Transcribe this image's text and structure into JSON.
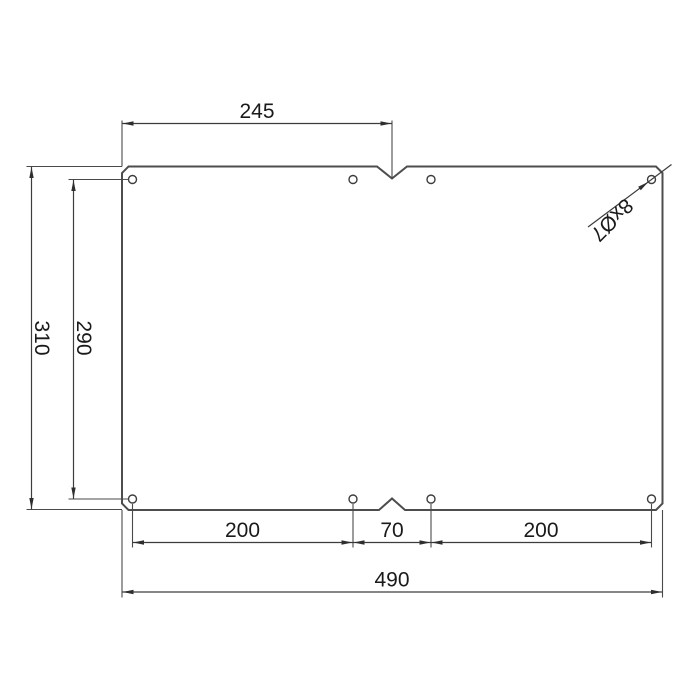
{
  "drawing": {
    "kind": "technical dimension drawing",
    "part": "rectangular plate with 8 holes, chamfered corners and center notches",
    "labels": {
      "top_width": "245",
      "overall_height": "310",
      "vertical_hole_span": "290",
      "bottom_left_span": "200",
      "bottom_center_span": "70",
      "bottom_right_span": "200",
      "overall_width": "490",
      "hole_callout": "8xØ7"
    },
    "colors": {
      "outline": "#4d4d4d",
      "dimension_line": "#3d3d3d",
      "text": "#1a1a1a",
      "background": "#ffffff"
    }
  }
}
